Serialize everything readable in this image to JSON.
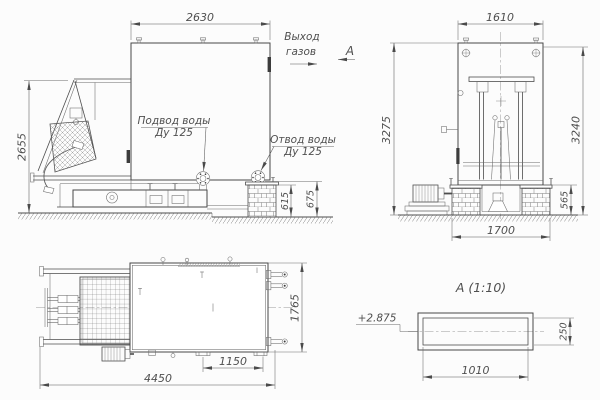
{
  "views": {
    "front": {
      "dim_width": "2630",
      "dim_height": "2655",
      "dim_flange_height": "615",
      "dim_outlet_height": "675",
      "label_water_supply": "Подвод воды",
      "label_water_supply_dn": "Ду 125",
      "label_water_drain": "Отвод воды",
      "label_water_drain_dn": "Ду 125",
      "label_gas_outlet_1": "Выход",
      "label_gas_outlet_2": "газов",
      "section_marker": "А"
    },
    "side": {
      "dim_width": "1610",
      "dim_height_left": "3275",
      "dim_height_right": "3240",
      "dim_base_width": "1700",
      "dim_base_height": "565"
    },
    "plan": {
      "dim_depth": "1765",
      "dim_drain_offset": "1150",
      "dim_length": "4450"
    },
    "detail": {
      "title": "А  (1:10)",
      "elevation": "+2.875",
      "dim_width": "1010",
      "dim_height": "250"
    }
  },
  "colors": {
    "line": "#474747",
    "dim_text": "#4f4f4f",
    "background": "#fcfcfc"
  }
}
